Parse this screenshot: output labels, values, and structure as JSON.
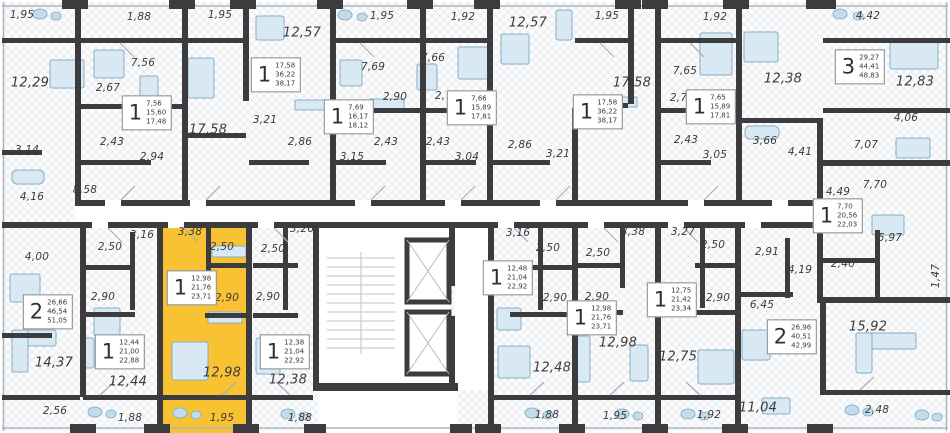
{
  "palette": {
    "wall": "#3c3c3e",
    "highlight": "#f8c232",
    "hatch": "#e7eaee",
    "floor": "#fdfdfe",
    "furniture_fill": "#d9e9f3",
    "furniture_stroke": "#85adc6",
    "deco_fill": "#c3dcec",
    "stair_line": "#c9cfd4",
    "door_line": "#a8afb5",
    "label_color": "#3b3b3d"
  },
  "room_labels": [
    {
      "t": "1,95",
      "x": 22,
      "y": 15
    },
    {
      "t": "1,88",
      "x": 139,
      "y": 17
    },
    {
      "t": "1,95",
      "x": 220,
      "y": 15
    },
    {
      "t": "1,95",
      "x": 382,
      "y": 16
    },
    {
      "t": "1,92",
      "x": 463,
      "y": 17
    },
    {
      "t": "1,95",
      "x": 607,
      "y": 16
    },
    {
      "t": "1,92",
      "x": 715,
      "y": 17
    },
    {
      "t": "4,42",
      "x": 868,
      "y": 16
    },
    {
      "t": "12,57",
      "x": 302,
      "y": 33,
      "lg": true
    },
    {
      "t": "12,57",
      "x": 528,
      "y": 23,
      "lg": true
    },
    {
      "t": "12,29",
      "x": 30,
      "y": 83,
      "lg": true
    },
    {
      "t": "7,56",
      "x": 143,
      "y": 63
    },
    {
      "t": "2,67",
      "x": 108,
      "y": 88
    },
    {
      "t": "17,58",
      "x": 208,
      "y": 130,
      "lg": true
    },
    {
      "t": "2,43",
      "x": 112,
      "y": 142
    },
    {
      "t": "2,94",
      "x": 152,
      "y": 157
    },
    {
      "t": "3,14",
      "x": 27,
      "y": 150
    },
    {
      "t": "4,16",
      "x": 32,
      "y": 197
    },
    {
      "t": "8,58",
      "x": 85,
      "y": 190
    },
    {
      "t": "3,21",
      "x": 265,
      "y": 120
    },
    {
      "t": "2,86",
      "x": 300,
      "y": 142
    },
    {
      "t": "7,69",
      "x": 373,
      "y": 67
    },
    {
      "t": "2,90",
      "x": 395,
      "y": 97
    },
    {
      "t": "2,43",
      "x": 386,
      "y": 142
    },
    {
      "t": "3,15",
      "x": 352,
      "y": 157
    },
    {
      "t": "7,66",
      "x": 433,
      "y": 58
    },
    {
      "t": "2,76",
      "x": 447,
      "y": 96
    },
    {
      "t": "2,43",
      "x": 438,
      "y": 142
    },
    {
      "t": "3,04",
      "x": 467,
      "y": 157
    },
    {
      "t": "2,86",
      "x": 520,
      "y": 145
    },
    {
      "t": "3,21",
      "x": 558,
      "y": 154
    },
    {
      "t": "17,58",
      "x": 632,
      "y": 83,
      "lg": true
    },
    {
      "t": "7,65",
      "x": 685,
      "y": 71
    },
    {
      "t": "2,76",
      "x": 682,
      "y": 98
    },
    {
      "t": "2,43",
      "x": 686,
      "y": 140
    },
    {
      "t": "3,05",
      "x": 715,
      "y": 155
    },
    {
      "t": "12,38",
      "x": 783,
      "y": 79,
      "lg": true
    },
    {
      "t": "3,66",
      "x": 765,
      "y": 141
    },
    {
      "t": "4,41",
      "x": 800,
      "y": 152
    },
    {
      "t": "12,83",
      "x": 915,
      "y": 82,
      "lg": true
    },
    {
      "t": "4,06",
      "x": 906,
      "y": 118
    },
    {
      "t": "7,07",
      "x": 866,
      "y": 145
    },
    {
      "t": "7,70",
      "x": 875,
      "y": 185
    },
    {
      "t": "4,49",
      "x": 838,
      "y": 192
    },
    {
      "t": "5,97",
      "x": 890,
      "y": 238
    },
    {
      "t": "2,40",
      "x": 843,
      "y": 264
    },
    {
      "t": "1,47",
      "x": 936,
      "y": 276,
      "r": true
    },
    {
      "t": "4,00",
      "x": 37,
      "y": 257
    },
    {
      "t": "14,37",
      "x": 54,
      "y": 363,
      "lg": true
    },
    {
      "t": "2,56",
      "x": 55,
      "y": 411
    },
    {
      "t": "3,16",
      "x": 142,
      "y": 235
    },
    {
      "t": "2,50",
      "x": 110,
      "y": 247
    },
    {
      "t": "2,90",
      "x": 103,
      "y": 297
    },
    {
      "t": "12,44",
      "x": 128,
      "y": 382,
      "lg": true
    },
    {
      "t": "1,88",
      "x": 130,
      "y": 418
    },
    {
      "t": "3,38",
      "x": 190,
      "y": 232
    },
    {
      "t": "2,50",
      "x": 222,
      "y": 247
    },
    {
      "t": "2,90",
      "x": 227,
      "y": 298
    },
    {
      "t": "12,98",
      "x": 222,
      "y": 373,
      "lg": true
    },
    {
      "t": "1,95",
      "x": 222,
      "y": 418
    },
    {
      "t": "3,26",
      "x": 302,
      "y": 229
    },
    {
      "t": "2,50",
      "x": 273,
      "y": 249
    },
    {
      "t": "2,90",
      "x": 268,
      "y": 297
    },
    {
      "t": "12,38",
      "x": 288,
      "y": 380,
      "lg": true
    },
    {
      "t": "1,88",
      "x": 300,
      "y": 418
    },
    {
      "t": "3,16",
      "x": 518,
      "y": 233
    },
    {
      "t": "2,50",
      "x": 548,
      "y": 248
    },
    {
      "t": "2,90",
      "x": 555,
      "y": 298
    },
    {
      "t": "12,48",
      "x": 552,
      "y": 368,
      "lg": true
    },
    {
      "t": "1,88",
      "x": 547,
      "y": 415
    },
    {
      "t": "3,38",
      "x": 633,
      "y": 232
    },
    {
      "t": "2,50",
      "x": 598,
      "y": 253
    },
    {
      "t": "2,90",
      "x": 597,
      "y": 297
    },
    {
      "t": "12,98",
      "x": 618,
      "y": 343,
      "lg": true
    },
    {
      "t": "1,95",
      "x": 615,
      "y": 416
    },
    {
      "t": "3,27",
      "x": 683,
      "y": 232
    },
    {
      "t": "2,50",
      "x": 713,
      "y": 245
    },
    {
      "t": "2,90",
      "x": 718,
      "y": 298
    },
    {
      "t": "12,75",
      "x": 678,
      "y": 357,
      "lg": true
    },
    {
      "t": "1,92",
      "x": 709,
      "y": 415
    },
    {
      "t": "2,91",
      "x": 767,
      "y": 252
    },
    {
      "t": "4,19",
      "x": 800,
      "y": 270
    },
    {
      "t": "6,45",
      "x": 762,
      "y": 305
    },
    {
      "t": "15,92",
      "x": 868,
      "y": 327,
      "lg": true
    },
    {
      "t": "11,04",
      "x": 758,
      "y": 408,
      "lg": true
    },
    {
      "t": "2,48",
      "x": 877,
      "y": 410
    }
  ],
  "unit_boxes": [
    {
      "n": "1",
      "vals": [
        "7,56",
        "15,60",
        "17,48"
      ],
      "x": 147,
      "y": 113
    },
    {
      "n": "1",
      "vals": [
        "17,58",
        "36,22",
        "38,17"
      ],
      "x": 276,
      "y": 75
    },
    {
      "n": "1",
      "vals": [
        "7,69",
        "16,17",
        "18,12"
      ],
      "x": 349,
      "y": 117
    },
    {
      "n": "1",
      "vals": [
        "7,66",
        "15,89",
        "17,81"
      ],
      "x": 472,
      "y": 108
    },
    {
      "n": "1",
      "vals": [
        "17,58",
        "36,22",
        "38,17"
      ],
      "x": 598,
      "y": 112
    },
    {
      "n": "1",
      "vals": [
        "7,65",
        "15,89",
        "17,81"
      ],
      "x": 711,
      "y": 107
    },
    {
      "n": "3",
      "vals": [
        "29,27",
        "44,41",
        "48,83"
      ],
      "x": 860,
      "y": 67
    },
    {
      "n": "1",
      "vals": [
        "7,70",
        "20,56",
        "22,03"
      ],
      "x": 838,
      "y": 216
    },
    {
      "n": "2",
      "vals": [
        "26,66",
        "46,54",
        "51,05"
      ],
      "x": 48,
      "y": 312
    },
    {
      "n": "1",
      "vals": [
        "12,44",
        "21,00",
        "22,88"
      ],
      "x": 120,
      "y": 352
    },
    {
      "n": "1",
      "vals": [
        "12,98",
        "21,76",
        "23,71"
      ],
      "x": 192,
      "y": 288,
      "hl": true
    },
    {
      "n": "1",
      "vals": [
        "12,38",
        "21,04",
        "22,92"
      ],
      "x": 285,
      "y": 352
    },
    {
      "n": "1",
      "vals": [
        "12,48",
        "21,04",
        "22,92"
      ],
      "x": 508,
      "y": 278
    },
    {
      "n": "1",
      "vals": [
        "12,98",
        "21,76",
        "23,71"
      ],
      "x": 592,
      "y": 318
    },
    {
      "n": "1",
      "vals": [
        "12,75",
        "21,42",
        "23,34"
      ],
      "x": 672,
      "y": 300
    },
    {
      "n": "2",
      "vals": [
        "26,96",
        "40,51",
        "42,99"
      ],
      "x": 792,
      "y": 337
    }
  ]
}
